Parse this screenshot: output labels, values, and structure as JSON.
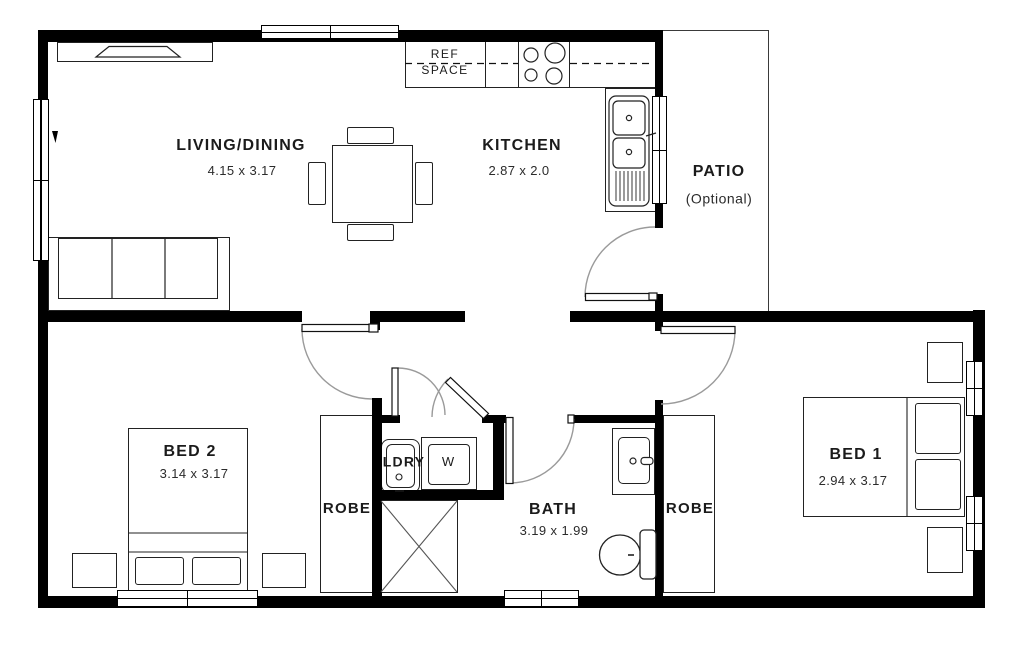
{
  "plan_title": "Granny flat floor plan",
  "rooms": {
    "living": {
      "name": "LIVING/DINING",
      "dims": "4.15 x 3.17"
    },
    "kitchen": {
      "name": "KITCHEN",
      "dims": "2.87 x 2.0"
    },
    "patio": {
      "name": "PATIO",
      "note": "(Optional)"
    },
    "bed2": {
      "name": "BED 2",
      "dims": "3.14 x 3.17"
    },
    "bed1": {
      "name": "BED 1",
      "dims": "2.94 x 3.17"
    },
    "bath": {
      "name": "BATH",
      "dims": "3.19 x 1.99"
    },
    "laundry": {
      "name": "LDRY"
    },
    "robe_bed2": {
      "name": "ROBE"
    },
    "robe_bed1": {
      "name": "ROBE"
    }
  },
  "fixtures": {
    "fridge_space": {
      "line1": "REF",
      "line2": "SPACE"
    },
    "washer": {
      "label": "W"
    }
  },
  "colors": {
    "walls": "#000000",
    "furniture_line": "#222222",
    "door_arc": "#9a9a9a",
    "background": "#ffffff"
  }
}
